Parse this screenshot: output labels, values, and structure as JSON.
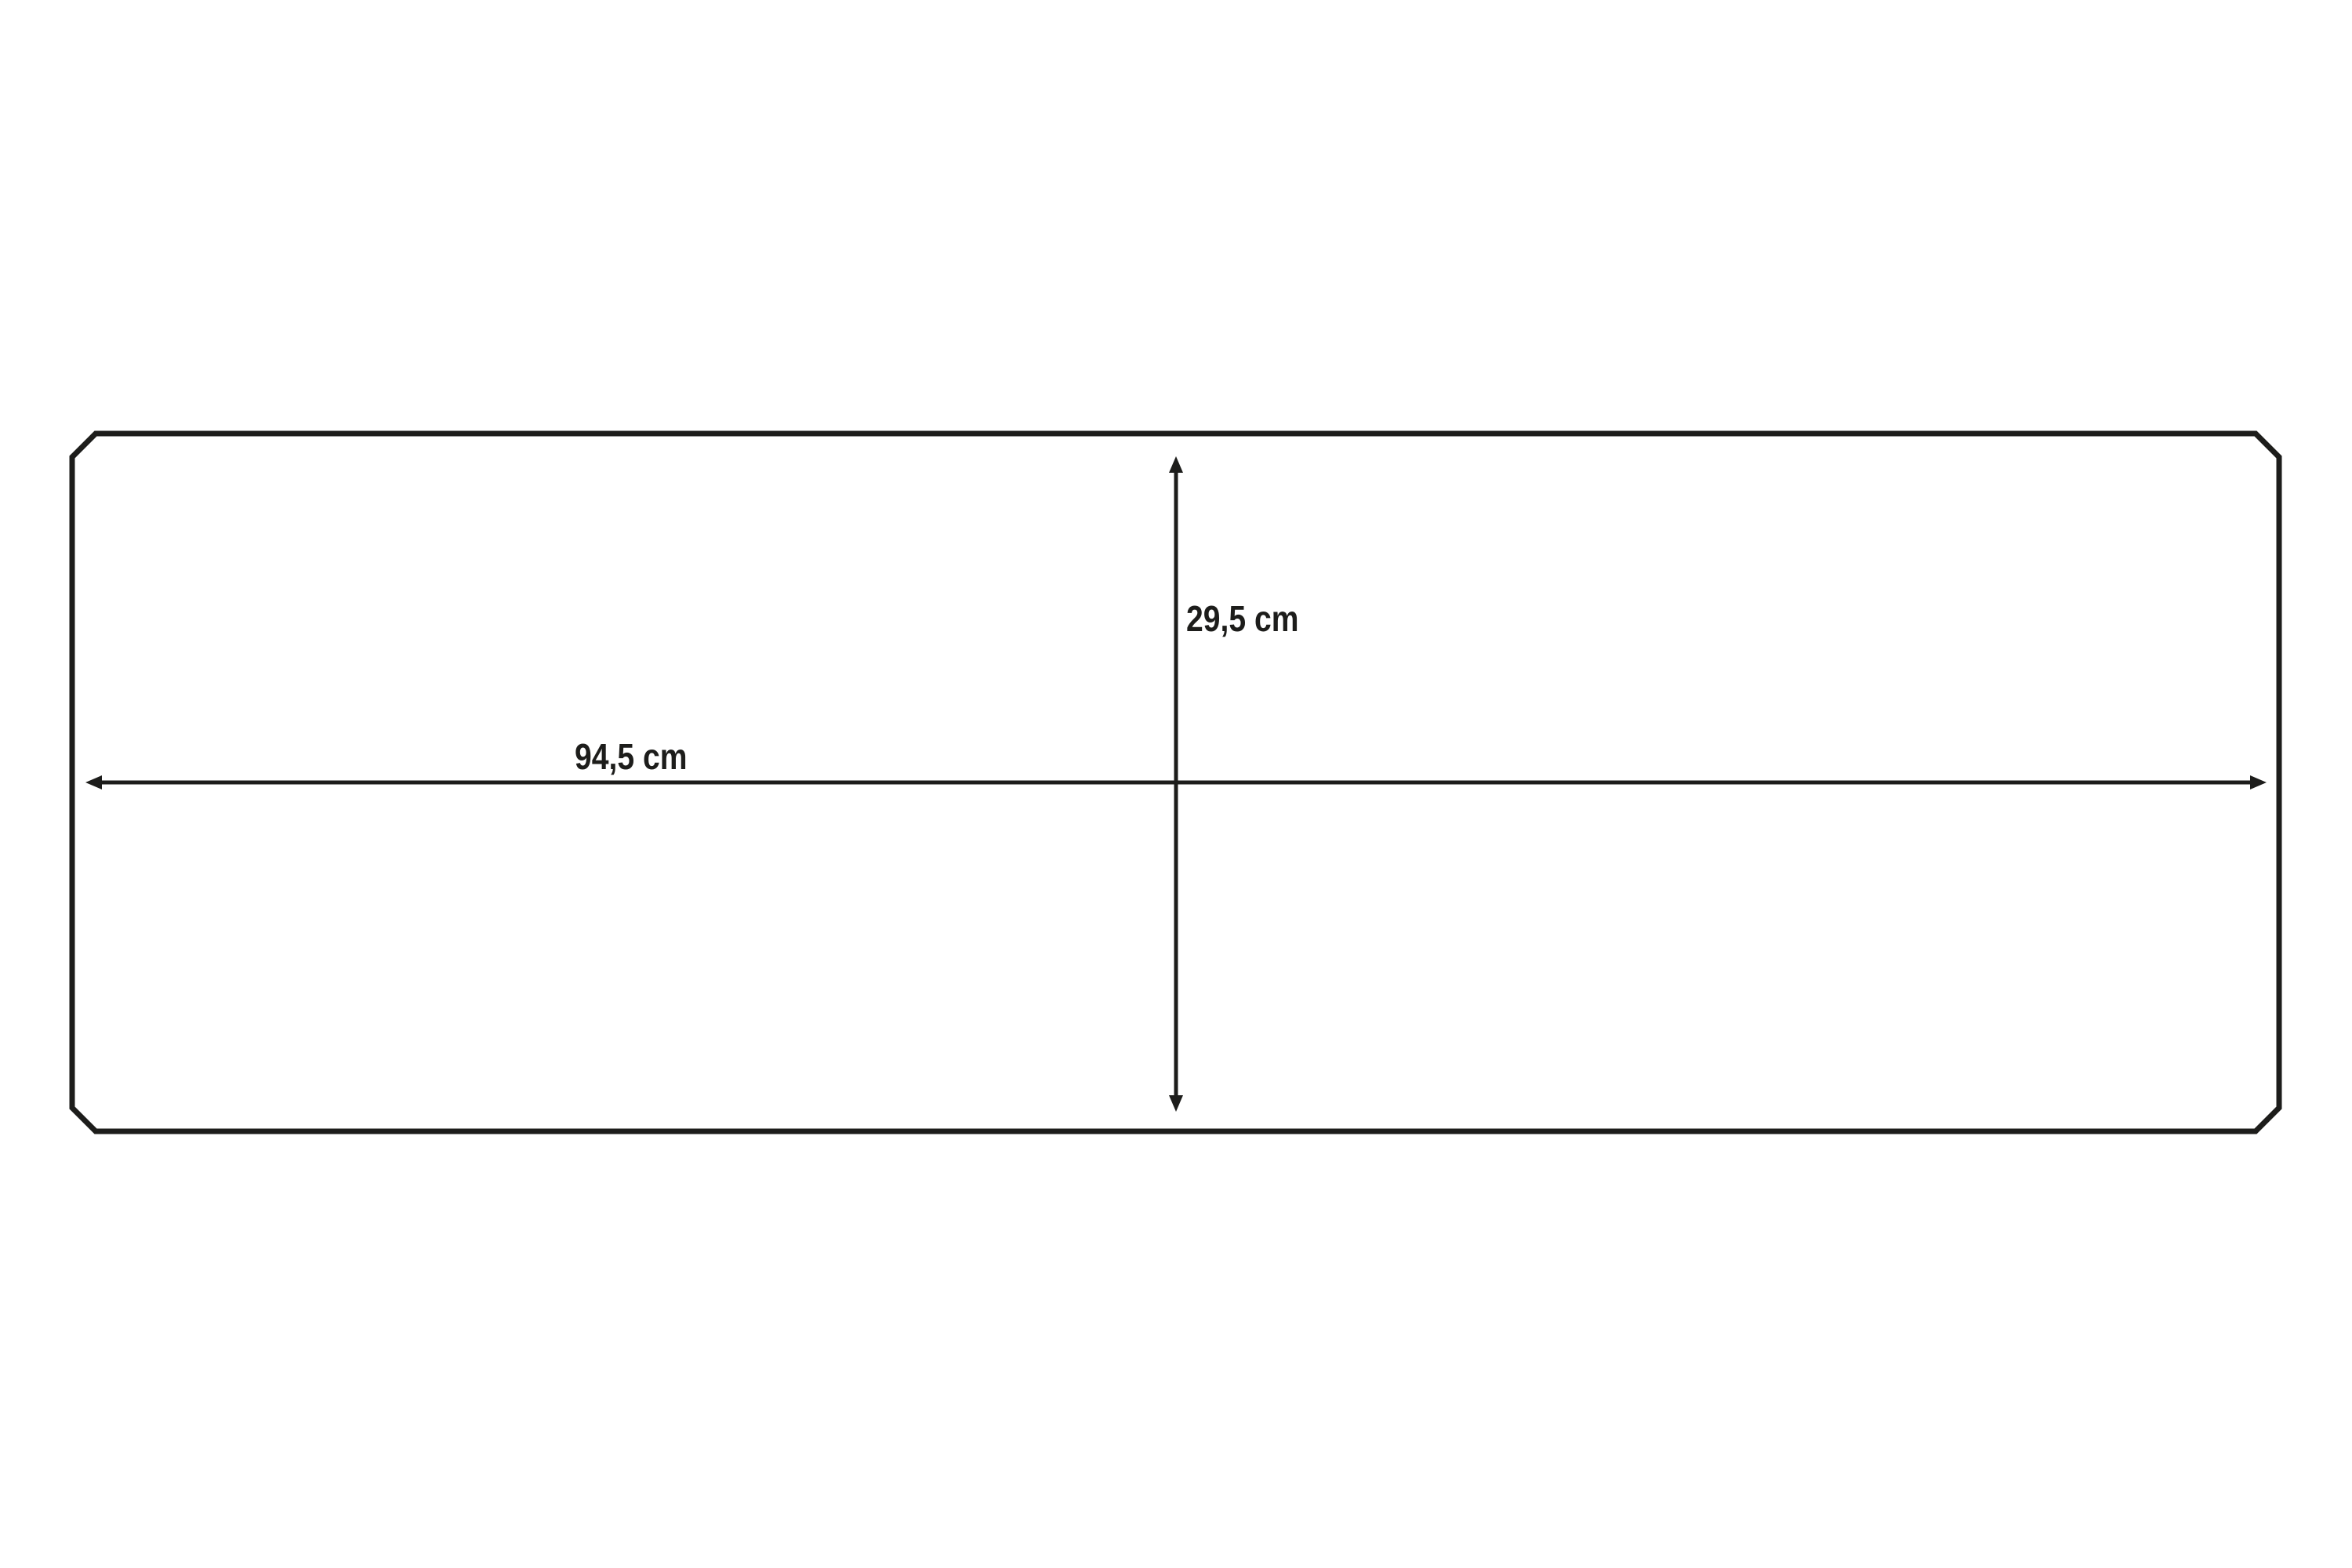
{
  "page": {
    "background_color": "#ffffff"
  },
  "diagram": {
    "type": "dimension-drawing",
    "shape": "rectangular-panel-with-chamfered-corners",
    "stroke_color": "#1d1d1b",
    "dimensions": {
      "width": {
        "label": "94,5 cm",
        "value": 94.5,
        "unit": "cm"
      },
      "height": {
        "label": "29,5 cm",
        "value": 29.5,
        "unit": "cm"
      }
    }
  }
}
